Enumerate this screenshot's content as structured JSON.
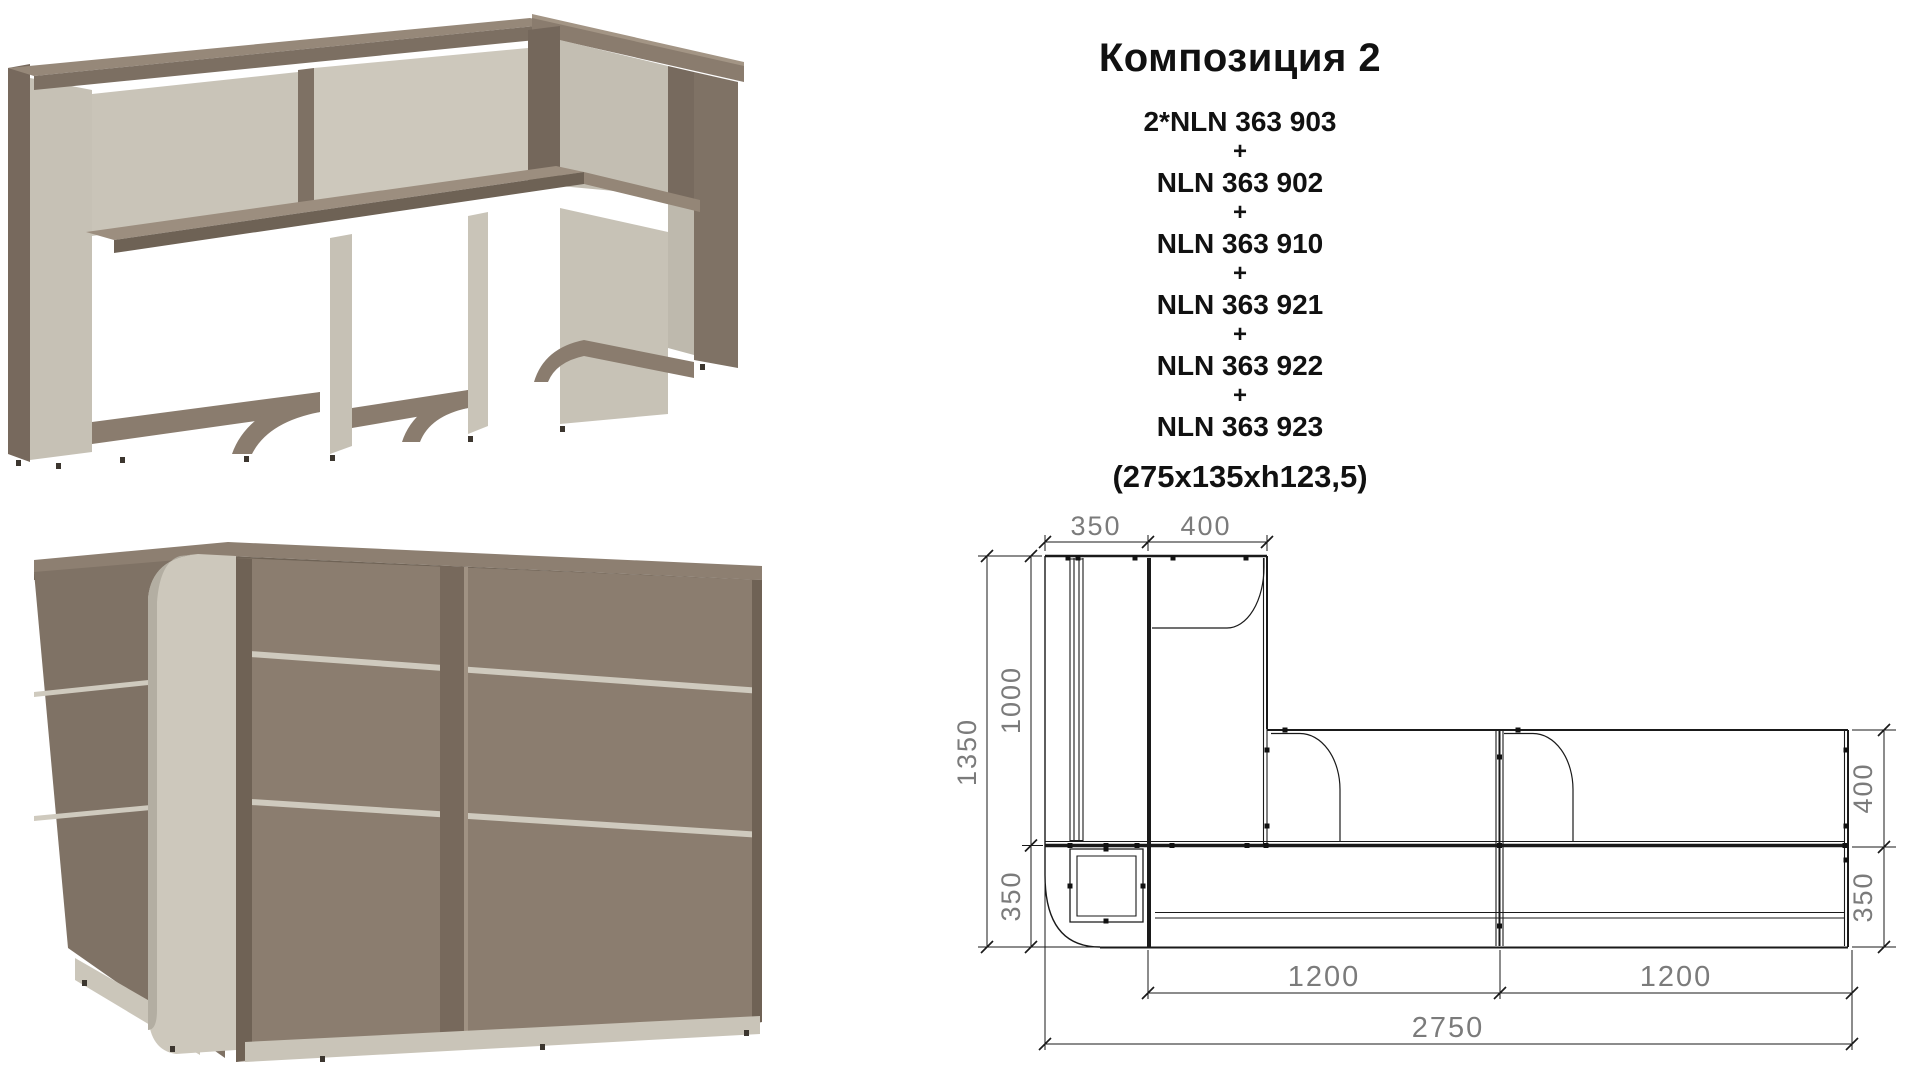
{
  "page": {
    "background": "#ffffff"
  },
  "info": {
    "title": "Композиция 2",
    "lines": [
      "2*NLN 363 903",
      "+",
      "NLN 363 902",
      "+",
      "NLN 363 910",
      "+",
      "NLN 363 921",
      "+",
      "NLN 363 922",
      "+",
      "NLN 363 923"
    ],
    "note": "(275x135xh123,5)"
  },
  "drawing": {
    "top": [
      "350",
      "400"
    ],
    "left": [
      "1350",
      "1000",
      "350"
    ],
    "right": [
      "400",
      "350"
    ],
    "bottom": [
      "1200",
      "1200",
      "2750"
    ],
    "line_color": "#1a1a1a",
    "dim_text_color": "#7b7b7b"
  },
  "renders": {
    "back_view_icon": "reception-desk-back-view",
    "front_view_icon": "reception-desk-front-view",
    "wood_color": "#8a7c6e",
    "wood_top_color": "#9a8c7d",
    "wood_dark_color": "#6f6357",
    "panel_color": "#c9c4b8",
    "panel_shadow_color": "#b3aea2"
  }
}
